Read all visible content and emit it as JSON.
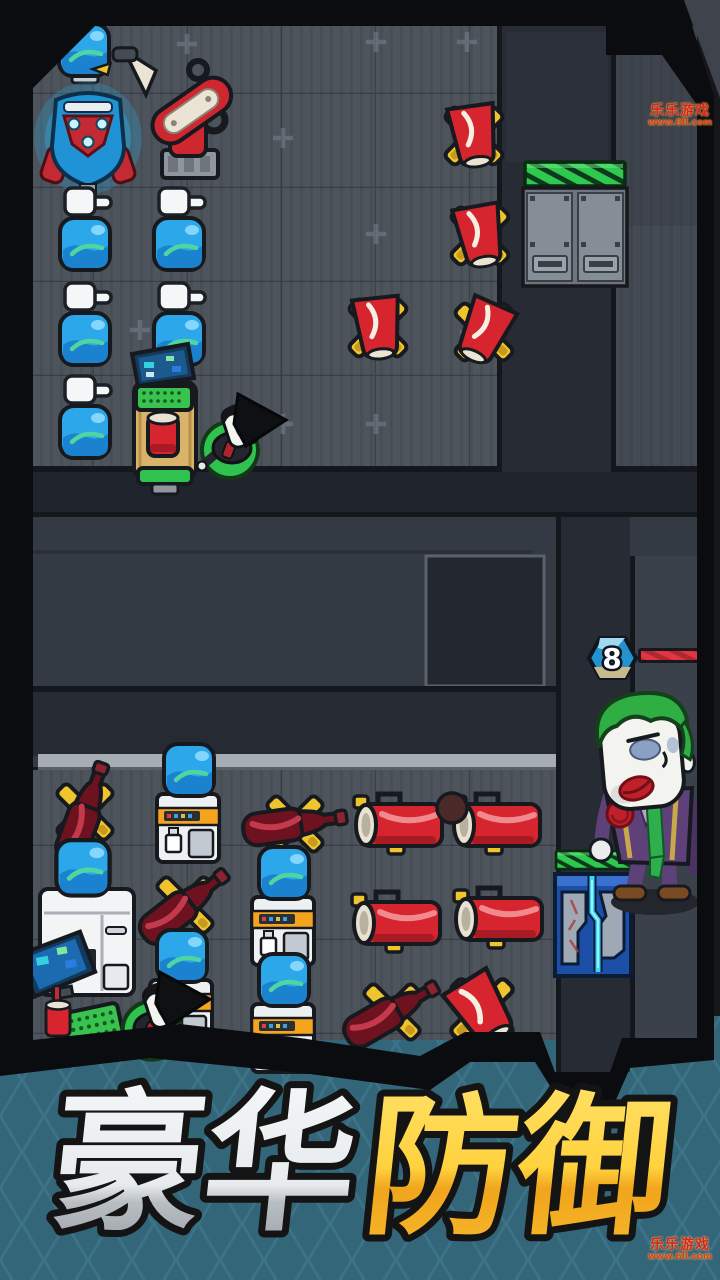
{
  "banner": {
    "title": "豪华防御",
    "title_white": "豪华",
    "title_gold": "防御",
    "bg_color": "#3c7389",
    "diamond_color": "#336679",
    "gold_top": "#ffdd55",
    "gold_bottom": "#f0a51d"
  },
  "watermark": {
    "brand": "乐乐游戏",
    "url": "www.6ll.com",
    "color": "#d5232a"
  },
  "enemy": {
    "type": "joker-clown",
    "level": "8",
    "health_percent": 100,
    "healthbar_color": "#e23540",
    "suit_color": "#5d4178",
    "hair_color": "#2fae44"
  },
  "colors": {
    "floor": "#4d545c",
    "corridor": "#262b34",
    "frame": "#0a0c0f",
    "green_bar": "#2ec94e",
    "door_blue": "#1e4fa8",
    "door_zigzag": "#38d9f6",
    "bottle_blue": "#2ba7ea",
    "turret_red": "#d6252e",
    "mount_yellow": "#f0c42c",
    "cola_dark_red": "#6e1220"
  },
  "units": [
    {
      "type": "water-bottle",
      "count": 1,
      "area": "top-room"
    },
    {
      "type": "energy-core-machine",
      "count": 1,
      "area": "top-room"
    },
    {
      "type": "robot-arm",
      "count": 1,
      "area": "top-room"
    },
    {
      "type": "water-dispenser",
      "count": 5,
      "area": "top-room"
    },
    {
      "type": "cup-turret",
      "count": 4,
      "area": "top-room"
    },
    {
      "type": "computer-desk",
      "count": 1,
      "area": "top-room"
    },
    {
      "type": "npc-worker",
      "count": 1,
      "area": "top-room"
    },
    {
      "type": "lockers",
      "count": 1,
      "area": "top-room"
    },
    {
      "type": "green-hazard-bar",
      "count": 2,
      "area": "map"
    },
    {
      "type": "water-cooler",
      "count": 4,
      "area": "bottom-room"
    },
    {
      "type": "fridge",
      "count": 1,
      "area": "bottom-room"
    },
    {
      "type": "cola-bottle-turret",
      "count": 4,
      "area": "bottom-room"
    },
    {
      "type": "soda-can-turret",
      "count": 4,
      "area": "bottom-room"
    },
    {
      "type": "cup-turret",
      "count": 1,
      "area": "bottom-room"
    },
    {
      "type": "computer-monitor",
      "count": 1,
      "area": "bottom-room"
    },
    {
      "type": "npc-worker",
      "count": 1,
      "area": "bottom-room"
    },
    {
      "type": "security-door",
      "count": 1,
      "area": "bottom-room"
    }
  ]
}
